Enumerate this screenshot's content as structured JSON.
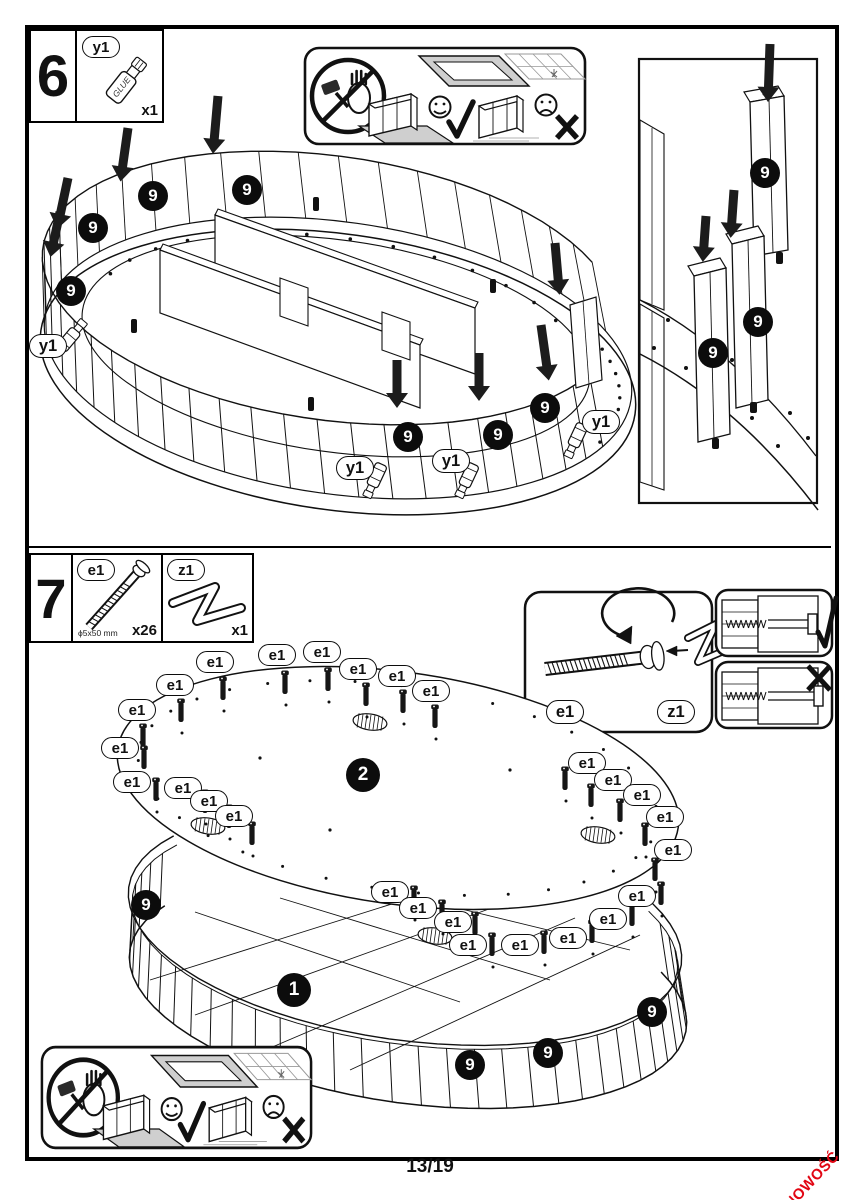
{
  "page": {
    "number": "13/19",
    "corner_badge": "NOWOŚĆ",
    "badge_color": "#e20613"
  },
  "step6": {
    "number": "6",
    "part_label": "y1",
    "part_qty": "x1",
    "bottle_text": "GLUE",
    "marker_slat": "9",
    "marker_glue": "y1"
  },
  "step7": {
    "number": "7",
    "screw_label": "e1",
    "screw_size": "ϕ5x50 mm",
    "screw_qty": "x26",
    "tool_label": "z1",
    "tool_qty": "x1",
    "marker_screw": "e1",
    "marker_tool": "z1",
    "marker_top_panel": "2",
    "marker_base": "1",
    "marker_slat": "9"
  },
  "warnings": {
    "icons": [
      "no-hammer-icon",
      "soft-surface-ok-icon",
      "hard-surface-bad-icon",
      "happy-face-icon",
      "sad-face-icon",
      "check-icon",
      "cross-icon"
    ]
  }
}
